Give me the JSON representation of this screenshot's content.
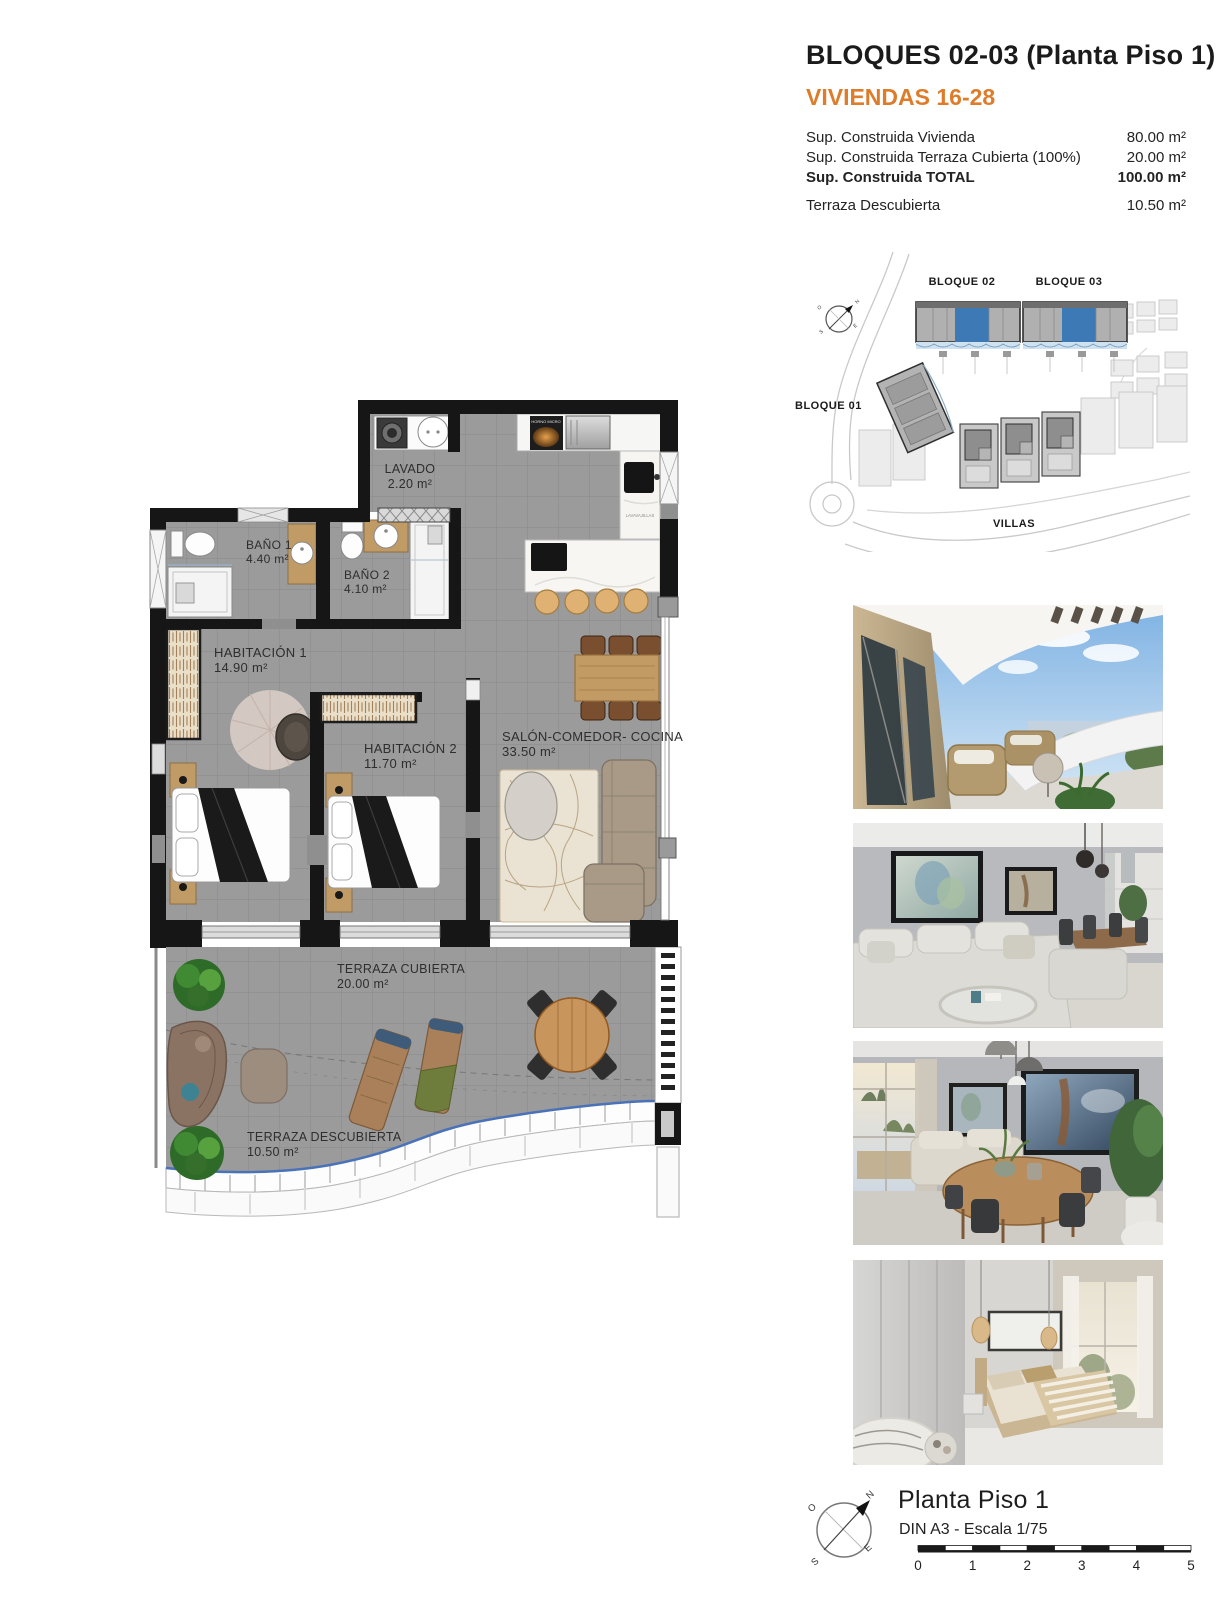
{
  "header": {
    "title": "BLOQUES 02-03  (Planta Piso 1)",
    "subtitle": "VIVIENDAS 16-28",
    "rows": [
      {
        "label": "Sup. Construida Vivienda",
        "value": "80.00 m²"
      },
      {
        "label": "Sup. Construida Terraza Cubierta (100%)",
        "value": "20.00 m²"
      },
      {
        "label": "Sup. Construida TOTAL",
        "value": "100.00 m²"
      },
      {
        "label": "Terraza Descubierta",
        "value": "10.50 m²"
      }
    ]
  },
  "site_plan": {
    "labels": {
      "bloque02": "BLOQUE 02",
      "bloque03": "BLOQUE 03",
      "bloque01": "BLOQUE 01",
      "villas": "VILLAS"
    }
  },
  "floor_plan": {
    "rooms": {
      "lavado": {
        "name": "LAVADO",
        "area": "2.20 m²"
      },
      "bano1": {
        "name": "BAÑO 1",
        "area": "4.40 m²"
      },
      "bano2": {
        "name": "BAÑO 2",
        "area": "4.10 m²"
      },
      "hab1": {
        "name": "HABITACIÓN 1",
        "area": "14.90 m²"
      },
      "hab2": {
        "name": "HABITACIÓN 2",
        "area": "11.70 m²"
      },
      "salon": {
        "name": "SALÓN-COMEDOR- COCINA",
        "area": "33.50 m²"
      },
      "terraza_cubierta": {
        "name": "TERRAZA CUBIERTA",
        "area": "20.00 m²"
      },
      "terraza_descubierta": {
        "name": "TERRAZA DESCUBIERTA",
        "area": "10.50 m²"
      }
    },
    "appliances": {
      "oven": "HORNO MICRO",
      "dishwasher": "LAVAVAJILLAS"
    }
  },
  "footer": {
    "title": "Planta Piso 1",
    "scale_note": "DIN A3 - Escala 1/75",
    "scale_ticks": [
      "0",
      "1",
      "2",
      "3",
      "4",
      "5"
    ],
    "compass": {
      "n": "N",
      "e": "E",
      "s": "S",
      "o": "O"
    }
  },
  "colors": {
    "accent_orange": "#DD7D2B",
    "site_highlight_blue": "#3D7AB5",
    "wall_black": "#161616",
    "floor_grey": "#9B9B9B",
    "railing_blue": "#4A72B8"
  }
}
